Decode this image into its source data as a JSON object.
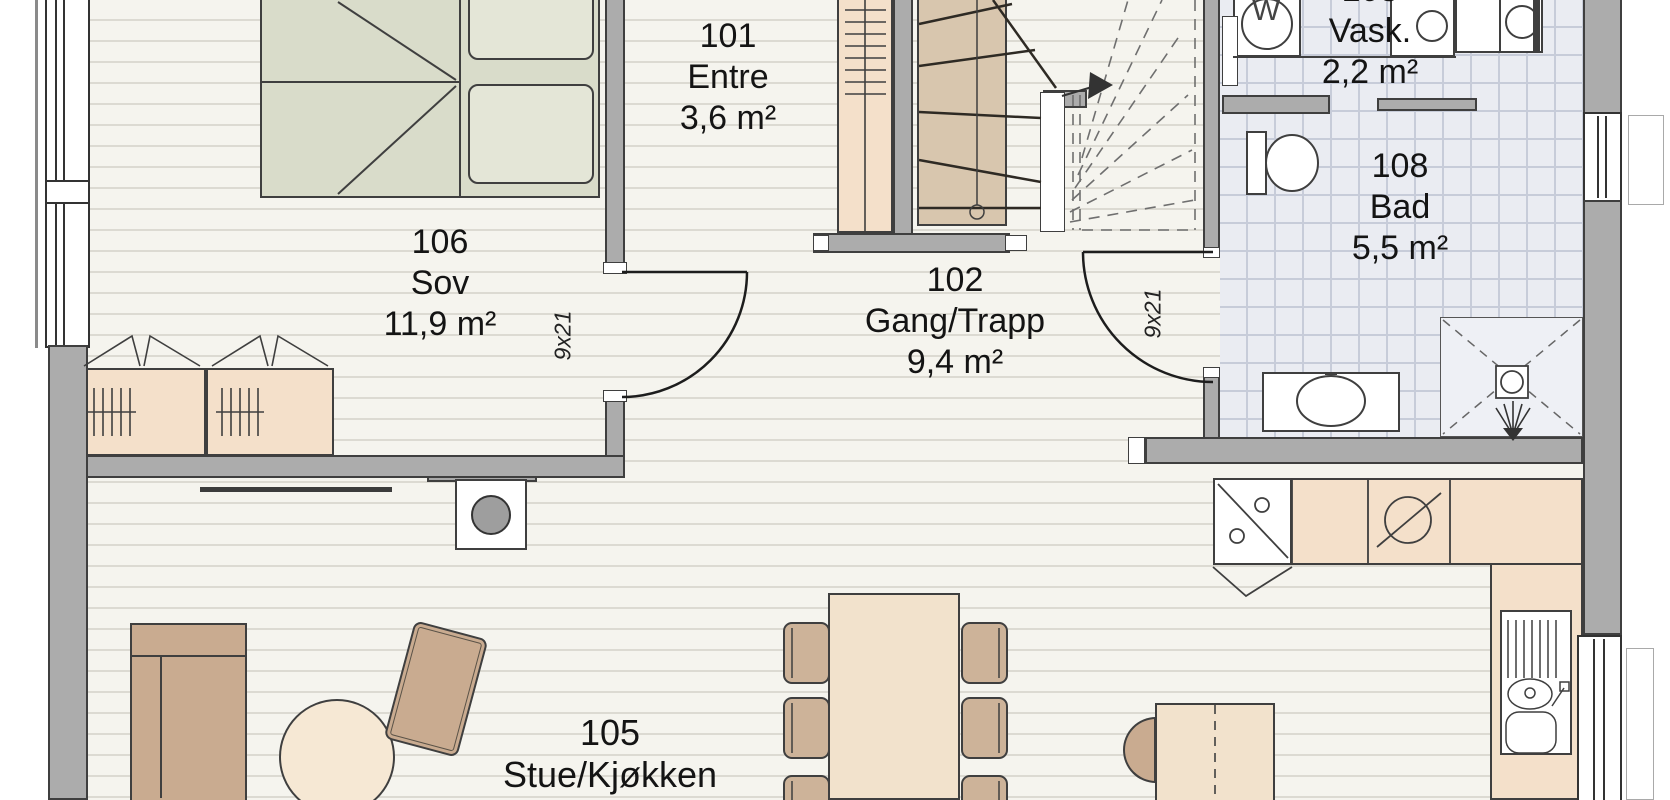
{
  "plan_title": "First floor plan",
  "rooms": {
    "entre": {
      "number": "101",
      "name": "Entre",
      "area": "3,6 m²"
    },
    "gang": {
      "number": "102",
      "name": "Gang/Trapp",
      "area": "9,4 m²"
    },
    "stue": {
      "number": "105",
      "name": "Stue/Kjøkken",
      "area": "34,6 m²"
    },
    "sov": {
      "number": "106",
      "name": "Sov",
      "area": "11,9 m²"
    },
    "vask": {
      "number": "103",
      "name": "Vask.",
      "area": "2,2 m²"
    },
    "bad": {
      "number": "108",
      "name": "Bad",
      "area": "5,5 m²"
    }
  },
  "doors": {
    "sov_door_size": "9x21",
    "bad_door_size": "9x21"
  },
  "appliances": {
    "washing_machine_label": "W"
  },
  "colors": {
    "wall": "#acacac",
    "wood_floor": "#f5f4ee",
    "wood_line": "#dcdad2",
    "tile_floor": "#eaecf2",
    "tile_line": "#c7ccd9",
    "furniture_tan": "#f4e0ca",
    "chair_tan": "#cdb399",
    "sofa_tan": "#c9ab90",
    "bed_green": "#d9dcca",
    "stair_tan": "#d8c6ae",
    "outline": "#3f3f3f"
  }
}
